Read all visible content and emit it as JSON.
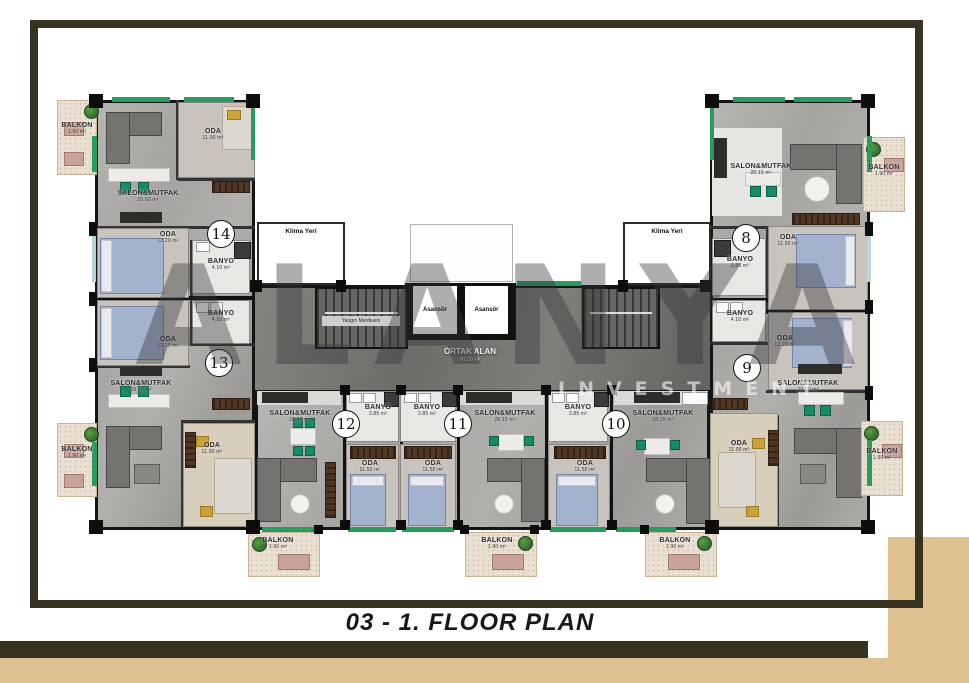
{
  "title": "03 - 1. FLOOR PLAN",
  "watermark": {
    "name": "ALANYA",
    "subtitle": "INVESTMENT"
  },
  "common_areas": {
    "klima_left": "Klima Yeri",
    "klima_right": "Klima Yeri",
    "elevator_1": "Asansör",
    "elevator_2": "Asansör",
    "fire_stairs": "Yangın Merdiveni",
    "ortak_alan": {
      "label": "ORTAK ALAN",
      "area": "41.20 m²"
    }
  },
  "units": {
    "u14": {
      "number": "14",
      "salon": {
        "label": "SALON&MUTFAK",
        "area": "29.50 m²"
      },
      "oda_top": {
        "label": "ODA",
        "area": "11.00 m²"
      },
      "oda_mid": {
        "label": "ODA",
        "area": "12.20 m²"
      },
      "banyo": {
        "label": "BANYO",
        "area": "4.10 m²"
      },
      "balkon": {
        "label": "BALKON",
        "area": "1.90 m²"
      }
    },
    "u13": {
      "number": "13",
      "salon": {
        "label": "SALON&MUTFAK",
        "area": "29.50 m²"
      },
      "oda_mid": {
        "label": "ODA",
        "area": "12.20 m²"
      },
      "oda_bottom": {
        "label": "ODA",
        "area": "11.00 m²"
      },
      "banyo": {
        "label": "BANYO",
        "area": "4.10 m²"
      },
      "balkon": {
        "label": "BALKON",
        "area": "1.90 m²"
      }
    },
    "u8": {
      "number": "8",
      "salon": {
        "label": "SALON&MUTFAK",
        "area": "28.15 m²"
      },
      "oda": {
        "label": "ODA",
        "area": "11.50 m²"
      },
      "banyo": {
        "label": "BANYO",
        "area": "3.85 m²"
      },
      "balkon": {
        "label": "BALKON",
        "area": "1.90 m²"
      }
    },
    "u9": {
      "number": "9",
      "salon": {
        "label": "SALON&MUTFAK",
        "area": "29.50 m²"
      },
      "oda_mid": {
        "label": "ODA",
        "area": "12.20 m²"
      },
      "oda_bottom": {
        "label": "ODA",
        "area": "11.00 m²"
      },
      "banyo": {
        "label": "BANYO",
        "area": "4.10 m²"
      },
      "balkon": {
        "label": "BALKON",
        "area": "1.90 m²"
      }
    },
    "u12": {
      "number": "12",
      "salon": {
        "label": "SALON&MUTFAK",
        "area": "28.15 m²"
      },
      "oda": {
        "label": "ODA",
        "area": "11.50 m²"
      },
      "banyo": {
        "label": "BANYO",
        "area": "3.85 m²"
      },
      "balkon": {
        "label": "BALKON",
        "area": "1.90 m²"
      }
    },
    "u11": {
      "number": "11",
      "salon": {
        "label": "SALON&MUTFAK",
        "area": "28.15 m²"
      },
      "oda": {
        "label": "ODA",
        "area": "11.50 m²"
      },
      "banyo": {
        "label": "BANYO",
        "area": "3.85 m²"
      },
      "balkon": {
        "label": "BALKON",
        "area": "1.90 m²"
      }
    },
    "u10": {
      "number": "10",
      "salon": {
        "label": "SALON&MUTFAK",
        "area": "28.15 m²"
      },
      "oda": {
        "label": "ODA",
        "area": "11.50 m²"
      },
      "banyo": {
        "label": "BANYO",
        "area": "3.85 m²"
      },
      "balkon": {
        "label": "BALKON",
        "area": "1.90 m²"
      }
    }
  },
  "colors": {
    "accent_green": "#2a9b5f",
    "frame": "#373320",
    "tan": "#dec191"
  }
}
